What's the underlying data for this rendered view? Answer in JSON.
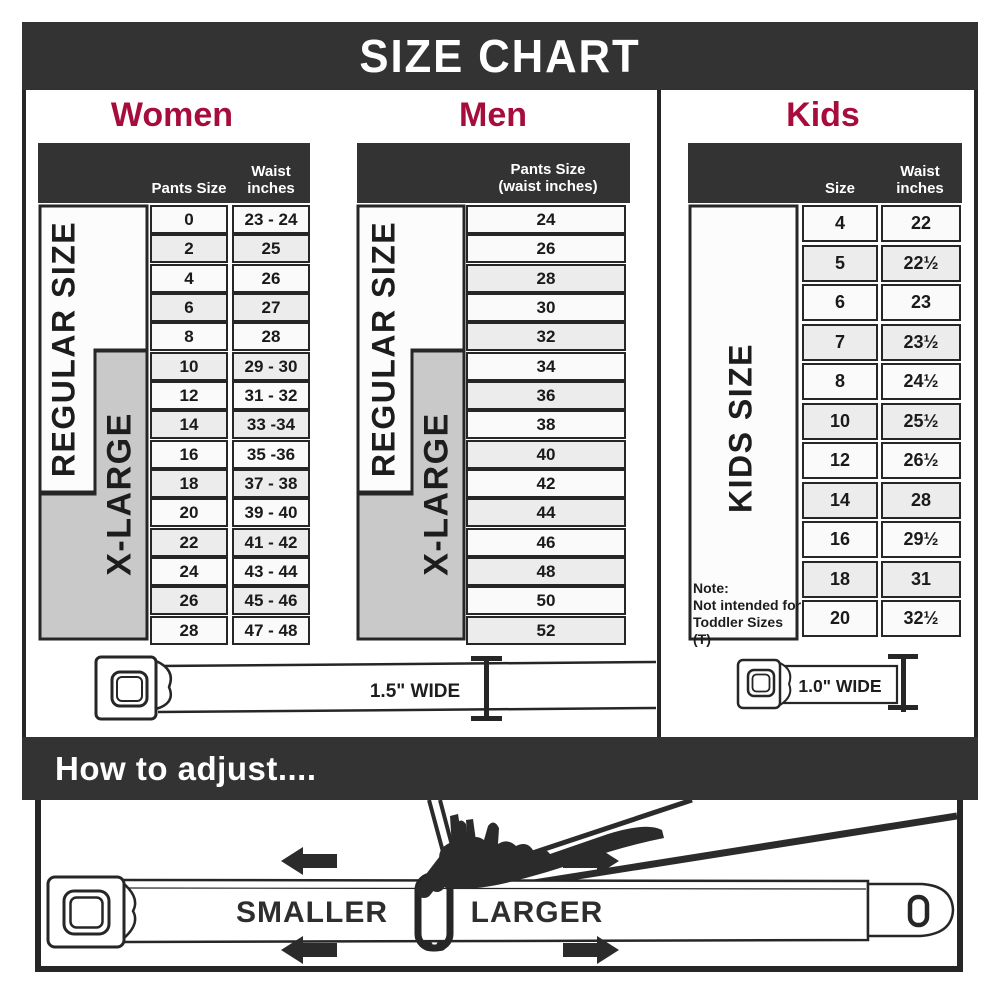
{
  "title": "SIZE CHART",
  "women": {
    "title": "Women",
    "col_pants": "Pants Size",
    "col_waist_1": "Waist",
    "col_waist_2": "inches",
    "side_regular": "REGULAR SIZE",
    "side_xlarge": "X-LARGE",
    "rows": [
      [
        "0",
        "23 - 24"
      ],
      [
        "2",
        "25"
      ],
      [
        "4",
        "26"
      ],
      [
        "6",
        "27"
      ],
      [
        "8",
        "28"
      ],
      [
        "10",
        "29 - 30"
      ],
      [
        "12",
        "31 - 32"
      ],
      [
        "14",
        "33 -34"
      ],
      [
        "16",
        "35 -36"
      ],
      [
        "18",
        "37 - 38"
      ],
      [
        "20",
        "39 - 40"
      ],
      [
        "22",
        "41 - 42"
      ],
      [
        "24",
        "43 - 44"
      ],
      [
        "26",
        "45 - 46"
      ],
      [
        "28",
        "47 - 48"
      ]
    ],
    "belt_label": "1.5\" WIDE"
  },
  "men": {
    "title": "Men",
    "header_1": "Pants Size",
    "header_2": "(waist inches)",
    "side_regular": "REGULAR SIZE",
    "side_xlarge": "X-LARGE",
    "rows": [
      "24",
      "26",
      "28",
      "30",
      "32",
      "34",
      "36",
      "38",
      "40",
      "42",
      "44",
      "46",
      "48",
      "50",
      "52"
    ]
  },
  "kids": {
    "title": "Kids",
    "col_size": "Size",
    "col_waist_1": "Waist",
    "col_waist_2": "inches",
    "side_label": "KIDS SIZE",
    "rows": [
      [
        "4",
        "22"
      ],
      [
        "5",
        "22½"
      ],
      [
        "6",
        "23"
      ],
      [
        "7",
        "23½"
      ],
      [
        "8",
        "24½"
      ],
      [
        "10",
        "25½"
      ],
      [
        "12",
        "26½"
      ],
      [
        "14",
        "28"
      ],
      [
        "16",
        "29½"
      ],
      [
        "18",
        "31"
      ],
      [
        "20",
        "32½"
      ]
    ],
    "note_1": "Note:",
    "note_2": "Not intended for",
    "note_3": "Toddler Sizes (T)",
    "belt_label": "1.0\" WIDE"
  },
  "adjust": {
    "title": "How to adjust....",
    "smaller": "SMALLER",
    "larger": "LARGER"
  },
  "colors": {
    "accent": "#a60d3c",
    "dark_bar": "#333333",
    "border": "#262626",
    "row_light": "#fafafa",
    "row_shaded": "#ececec",
    "xlarge_gray": "#c9c9c9"
  }
}
